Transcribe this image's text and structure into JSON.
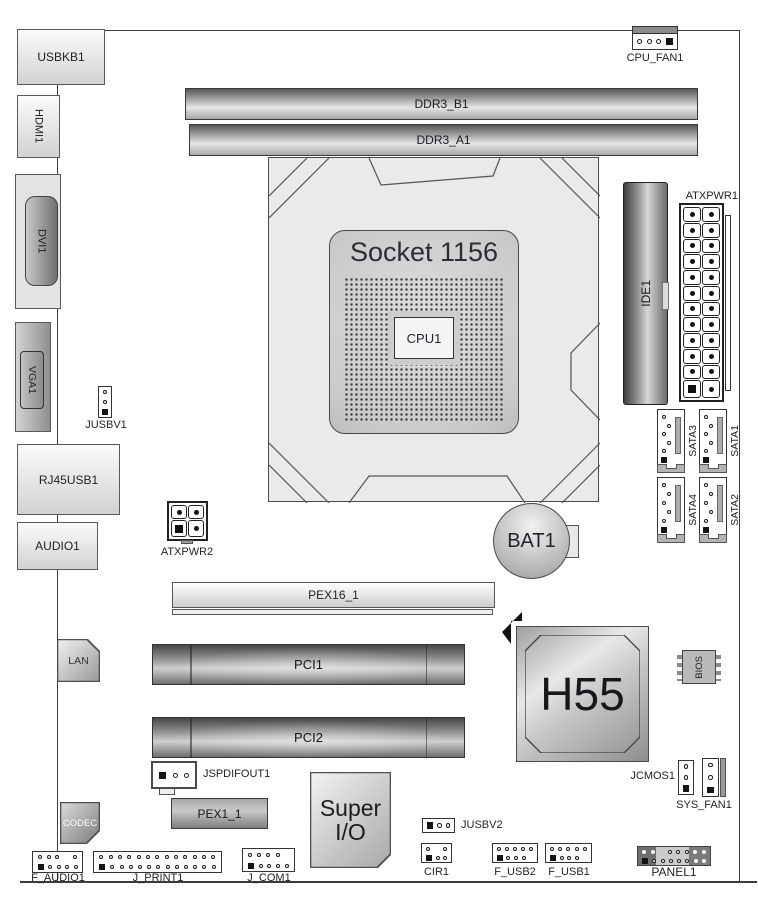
{
  "diagram_title": "Motherboard layout diagram",
  "colors": {
    "background": "#ffffff",
    "board_outline": "#3c3c3c",
    "label_text": "#23232b",
    "socket_text": "#2d2d35",
    "slot_dark": "#474747",
    "slot_light": "#e6e6e6",
    "chip_metal": "#c7c7c7",
    "pin_black": "#141414"
  },
  "components": {
    "usbkb1": "USBKB1",
    "hdmi1": "HDMI1",
    "dvi1": "DVI1",
    "vga1": "VGA1",
    "jusbv1": "JUSBV1",
    "rj45usb1": "RJ45USB1",
    "audio1": "AUDIO1",
    "atxpwr2": "ATXPWR2",
    "cpu_fan1": "CPU_FAN1",
    "ddr3_b1": "DDR3_B1",
    "ddr3_a1": "DDR3_A1",
    "socket": "Socket 1156",
    "cpu1": "CPU1",
    "ide1": "IDE1",
    "atxpwr1": "ATXPWR1",
    "sata3": "SATA3",
    "sata1": "SATA1",
    "sata4": "SATA4",
    "sata2": "SATA2",
    "bat1": "BAT1",
    "pex16_1": "PEX16_1",
    "pci1": "PCI1",
    "pci2": "PCI2",
    "h55": "H55",
    "bios": "BIOS",
    "lan": "LAN",
    "codec": "CODEC",
    "jspdifout1": "JSPDIFOUT1",
    "pex1_1": "PEX1_1",
    "super_io_line1": "Super",
    "super_io_line2": "I/O",
    "jusbv2": "JUSBV2",
    "cir1": "CIR1",
    "f_usb2": "F_USB2",
    "f_usb1": "F_USB1",
    "f_audio1": "F_AUDIO1",
    "j_print1": "J_PRINT1",
    "j_com1": "J_COM1",
    "panel1": "PANEL1",
    "jcmos1": "JCMOS1",
    "sys_fan1": "SYS_FAN1"
  }
}
